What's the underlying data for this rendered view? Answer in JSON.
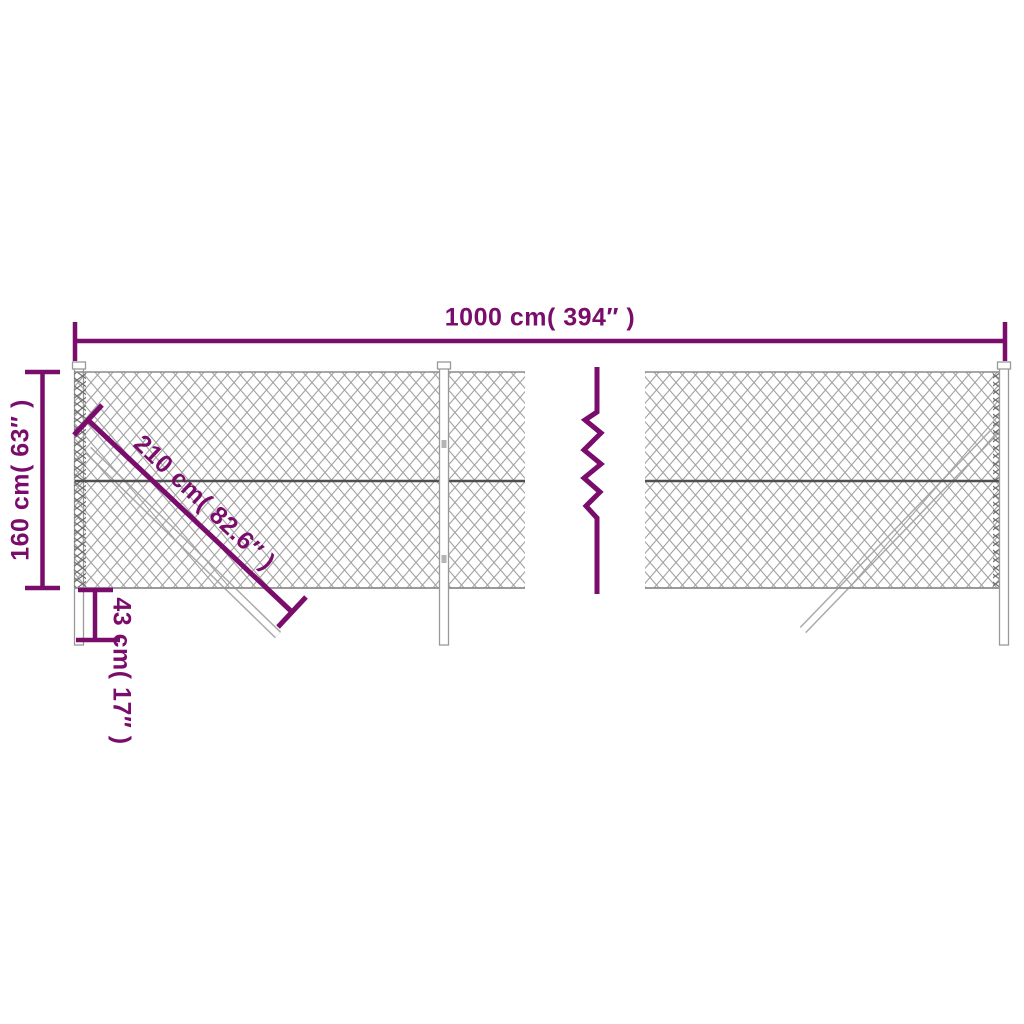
{
  "diagram": {
    "title": "chain-link fence dimension diagram",
    "labels": {
      "width": "1000 cm( 394″ )",
      "height": "160 cm( 63″ )",
      "brace": "210 cm( 82.6″ )",
      "depth": "43 cm( 17″ )"
    },
    "colors": {
      "accent": "#7a0d6b",
      "mesh": "#a3a3a3",
      "mesh_edge": "#6f6f6f",
      "wire": "#4f4f4f",
      "post_outline": "#999999",
      "background": "#ffffff"
    }
  }
}
